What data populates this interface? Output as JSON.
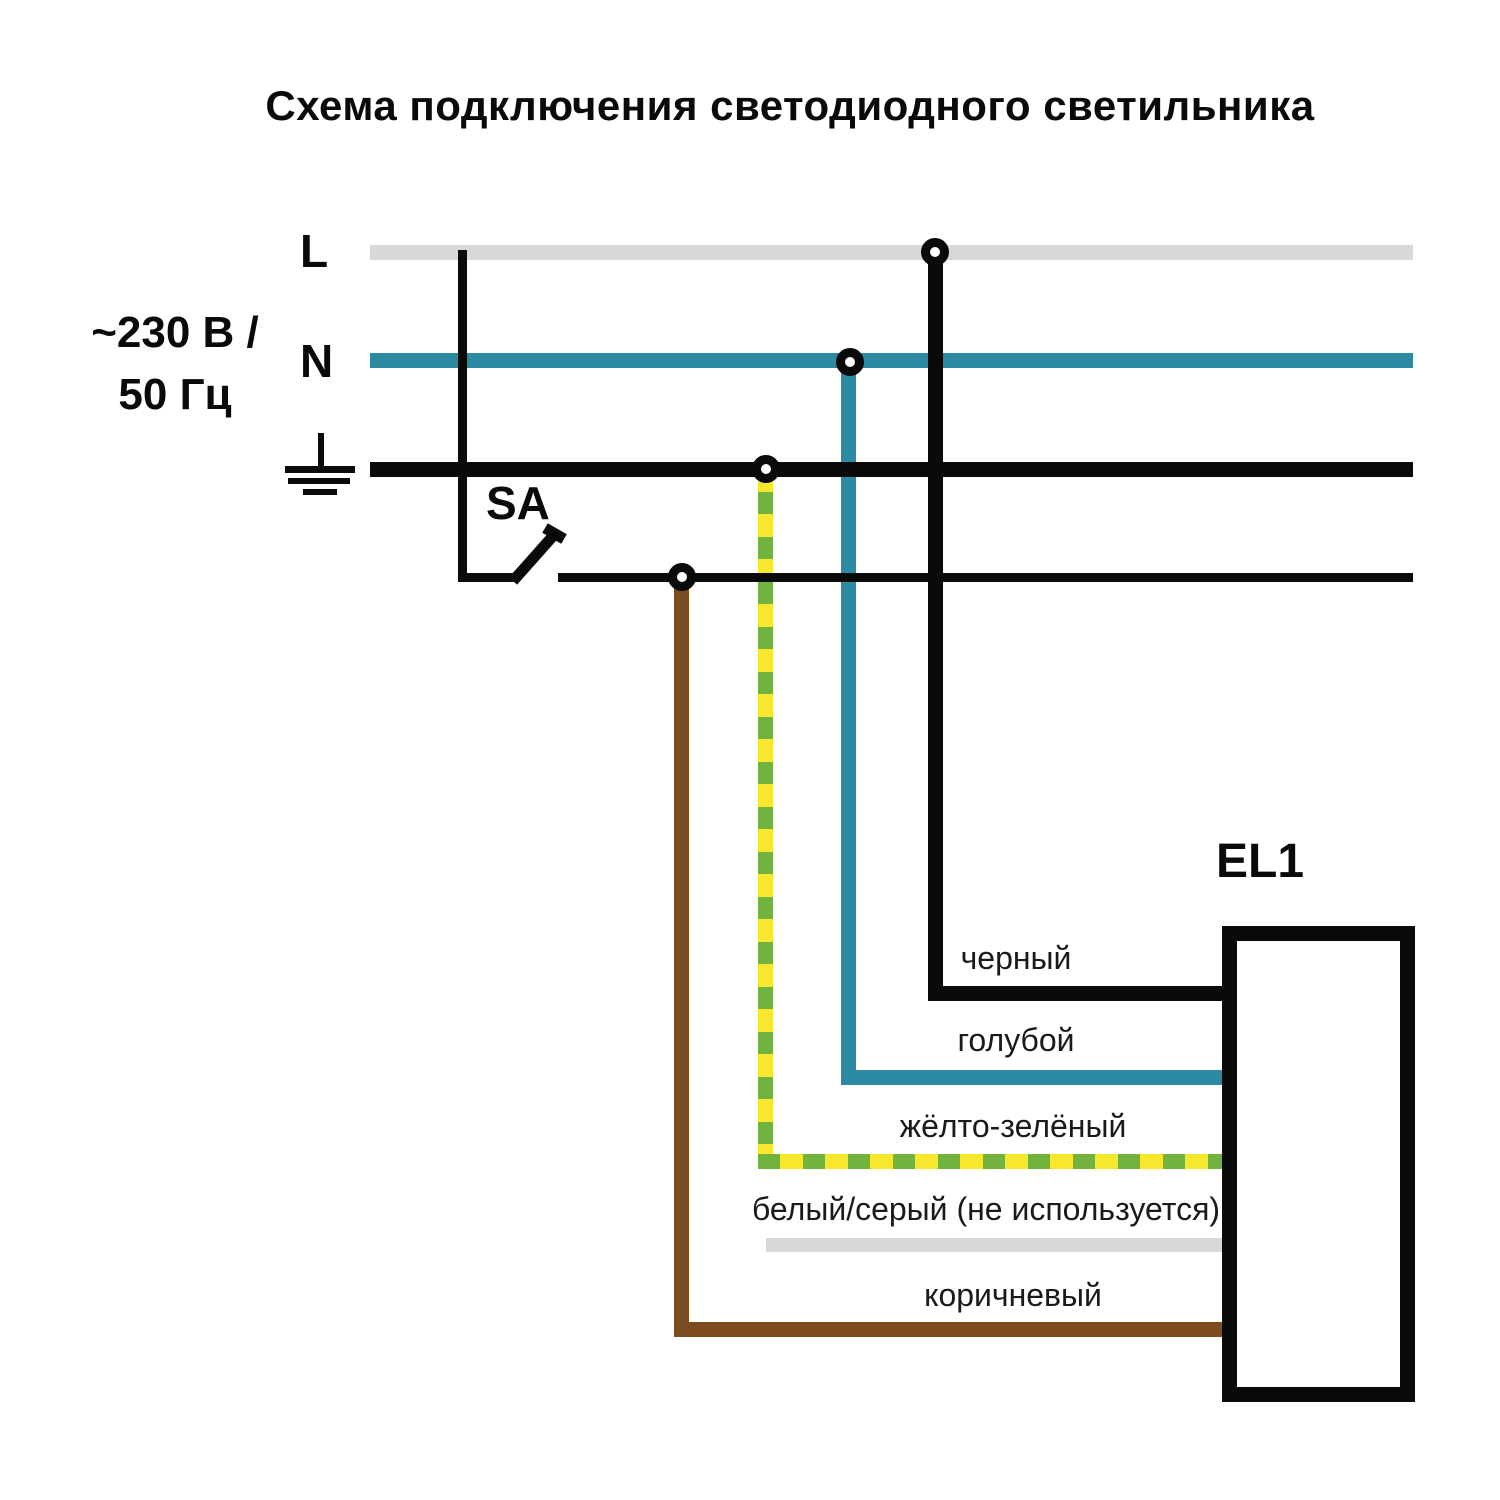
{
  "title": "Схема подключения светодиодного светильника",
  "power_source": {
    "voltage_line1": "~230 В /",
    "voltage_line2": "50 Гц",
    "l_label": "L",
    "n_label": "N",
    "pe_symbol": "earth-ground"
  },
  "switch": {
    "label": "SA",
    "state": "open"
  },
  "luminaire": {
    "label": "EL1"
  },
  "wires": {
    "black": {
      "label": "черный",
      "color": "#0a0a0a"
    },
    "blue": {
      "label": "голубой",
      "color": "#2b8ba3"
    },
    "yellow_green": {
      "label": "жёлто-зелёный",
      "color_yellow": "#f7e72d",
      "color_green": "#72b340"
    },
    "white_gray": {
      "label": "белый/серый (не используется)",
      "color": "#d8d8d8"
    },
    "brown": {
      "label": "коричневый",
      "color": "#7c4b1e"
    }
  },
  "colors": {
    "bus_l": "#d8d8d8",
    "bus_n": "#2b8ba3",
    "bus_pe": "#0a0a0a",
    "background": "#ffffff"
  }
}
